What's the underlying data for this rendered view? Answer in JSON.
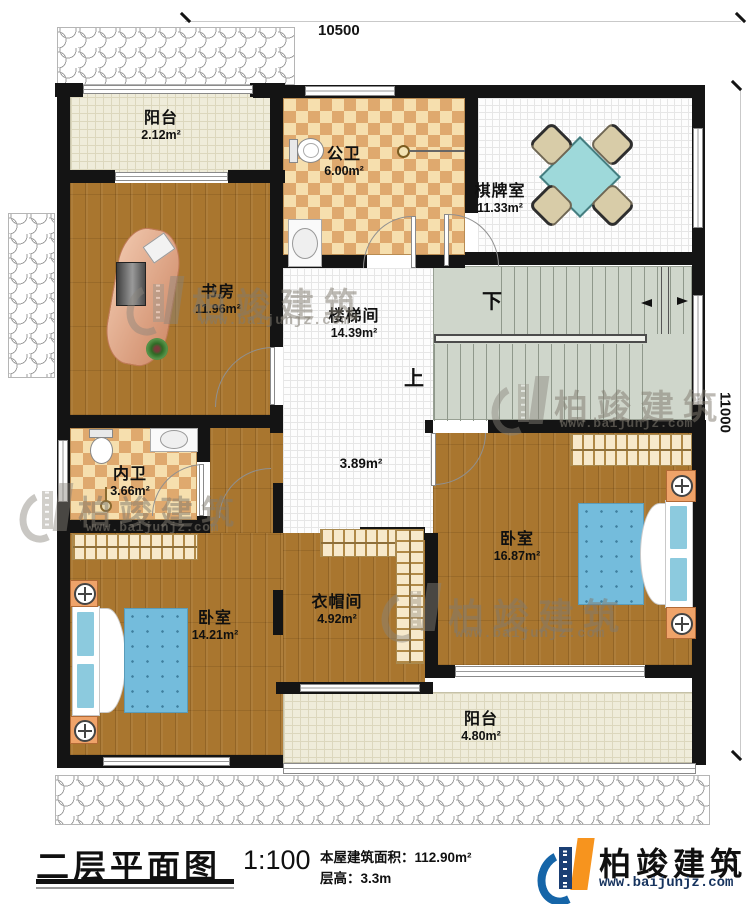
{
  "dimensions": {
    "top": "10500",
    "right": "11000"
  },
  "rooms": {
    "balcony_top": {
      "name": "阳台",
      "area": "2.12m²"
    },
    "public_bath": {
      "name": "公卫",
      "area": "6.00m²"
    },
    "chess_room": {
      "name": "棋牌室",
      "area": "11.33m²"
    },
    "study": {
      "name": "书房",
      "area": "11.96m²"
    },
    "stairwell": {
      "name": "楼梯间",
      "area": "14.39m²"
    },
    "hall": {
      "area": "3.89m²"
    },
    "private_bath": {
      "name": "内卫",
      "area": "3.66m²"
    },
    "bedroom_right": {
      "name": "卧室",
      "area": "16.87m²"
    },
    "cloakroom": {
      "name": "衣帽间",
      "area": "4.92m²"
    },
    "bedroom_left": {
      "name": "卧室",
      "area": "14.21m²"
    },
    "balcony_bottom": {
      "name": "阳台",
      "area": "4.80m²"
    }
  },
  "stairs": {
    "up": "上",
    "down": "下"
  },
  "watermark": {
    "text": "柏竣建筑",
    "url": "www.baijunjz.com"
  },
  "footer": {
    "title": "二层平面图",
    "scale": "1:100",
    "area_label": "本屋建筑面积：",
    "area_value": "112.90m²",
    "height_label": "层高：",
    "height_value": "3.3m",
    "brand": "柏竣建筑",
    "brand_url": "www.baijunjz.com"
  },
  "colors": {
    "wall": "#141414",
    "wood_floor": "#a9762f",
    "bath_tile": "#f6dfae",
    "stair": "#cfd6cb",
    "bed": "#74bcdc",
    "table": "#9ed9da",
    "brand_blue": "#1565a8",
    "brand_orange": "#f7941e",
    "brand_navy": "#1b3f74"
  }
}
